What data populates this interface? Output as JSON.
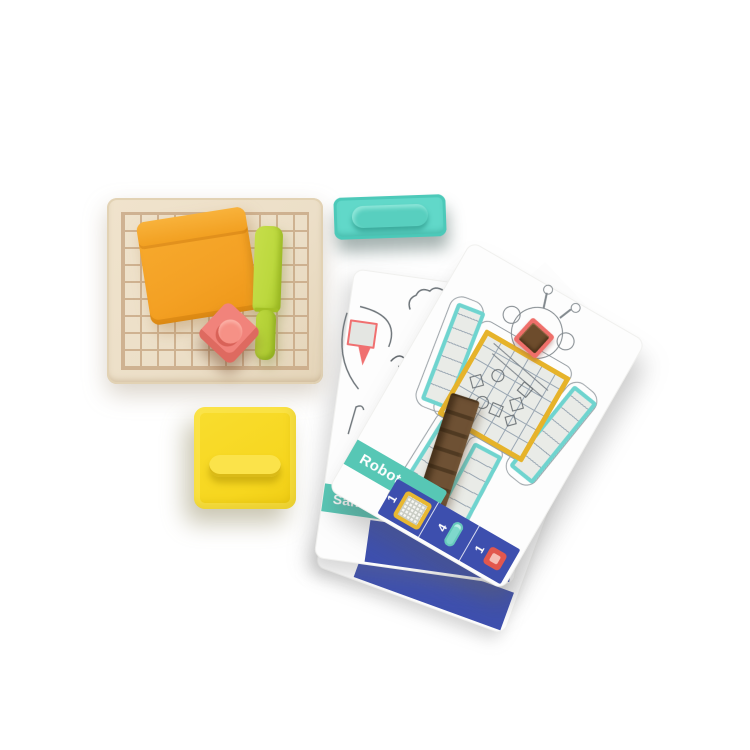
{
  "cards": {
    "robot": {
      "label": "Robot",
      "footer": [
        {
          "count": "1",
          "icon": "yellow-grid-stamp-icon"
        },
        {
          "count": "4",
          "icon": "teal-capsule-stamp-icon"
        },
        {
          "count": "1",
          "icon": "red-square-stamp-icon"
        }
      ]
    },
    "sand_castle": {
      "label": "Sand Castle"
    },
    "hidden": {
      "label": "W"
    }
  },
  "colors": {
    "tray_wood": "#ecdfc8",
    "tray_grid_lines": "#c5a37f",
    "scraper_orange": "#f4a124",
    "spatula_green": "#bcd83e",
    "knob_stamp_red": "#f1837b",
    "square_stamp_yellow": "#f6d61e",
    "bar_stamp_teal": "#61d8c9",
    "card_banner_teal": "#57c7b5",
    "card_footer_indigo": "#3d4fae",
    "robot_body_grid_yellow": "#e6b32a",
    "robot_limb_grid_teal": "#6fd4cf",
    "sand_brown": "#6e5134",
    "sketch_gray": "#81888d",
    "flag_red": "#f07070"
  }
}
